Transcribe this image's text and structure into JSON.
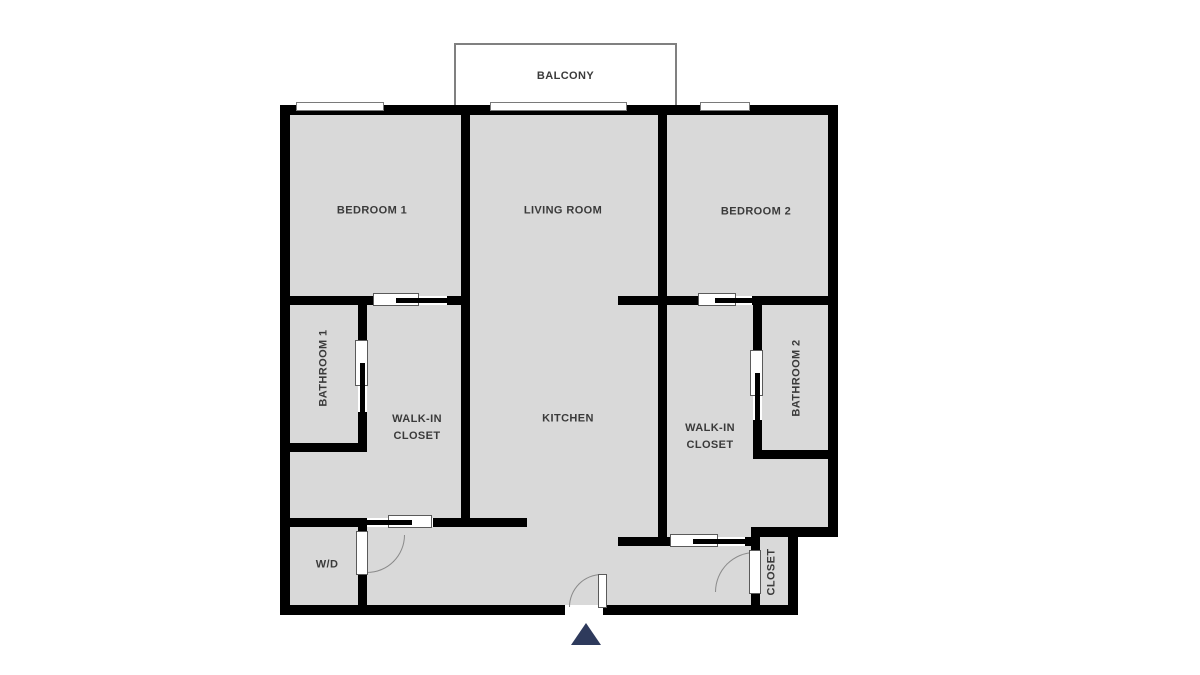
{
  "floorplan": {
    "balcony_label": "BALCONY",
    "rooms": {
      "bedroom1": {
        "label": "BEDROOM 1"
      },
      "living_room": {
        "label": "LIVING ROOM"
      },
      "bedroom2": {
        "label": "BEDROOM 2"
      },
      "bathroom1": {
        "label": "BATHROOM 1"
      },
      "walk_in_closet1": {
        "label_line1": "WALK-IN",
        "label_line2": "CLOSET"
      },
      "kitchen": {
        "label": "KITCHEN"
      },
      "walk_in_closet2": {
        "label_line1": "WALK-IN",
        "label_line2": "CLOSET"
      },
      "bathroom2": {
        "label": "BATHROOM 2"
      },
      "washer_dryer": {
        "label": "W/D"
      },
      "closet": {
        "label": "CLOSET"
      }
    },
    "colors": {
      "wall": "#000000",
      "floor": "#d9d9d9",
      "background": "#ffffff",
      "label": "#3a3a3a",
      "entry_arrow": "#2e3a5c"
    }
  }
}
